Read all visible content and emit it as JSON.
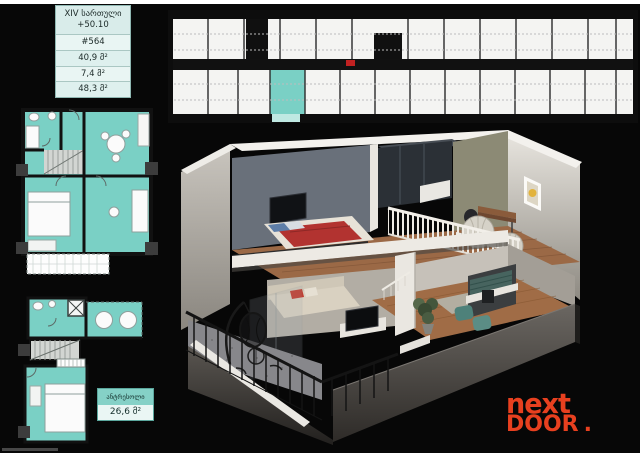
{
  "info_box": {
    "floor_label": "XIV სართული",
    "elevation": "+50.10",
    "unit_number": "#564",
    "area_apartment": "40,9 მ²",
    "area_balcony": "7,4 მ²",
    "area_total": "48,3 მ²"
  },
  "mezzanine_box": {
    "title": "ანტრესოლი",
    "area": "26,6 მ²"
  },
  "logo": {
    "word_top": "next",
    "word_bottom": "DOOR",
    "dot": "."
  },
  "colors": {
    "highlight_teal": "#7ad0c5",
    "logo_red": "#e8401f",
    "background": "#070707"
  }
}
